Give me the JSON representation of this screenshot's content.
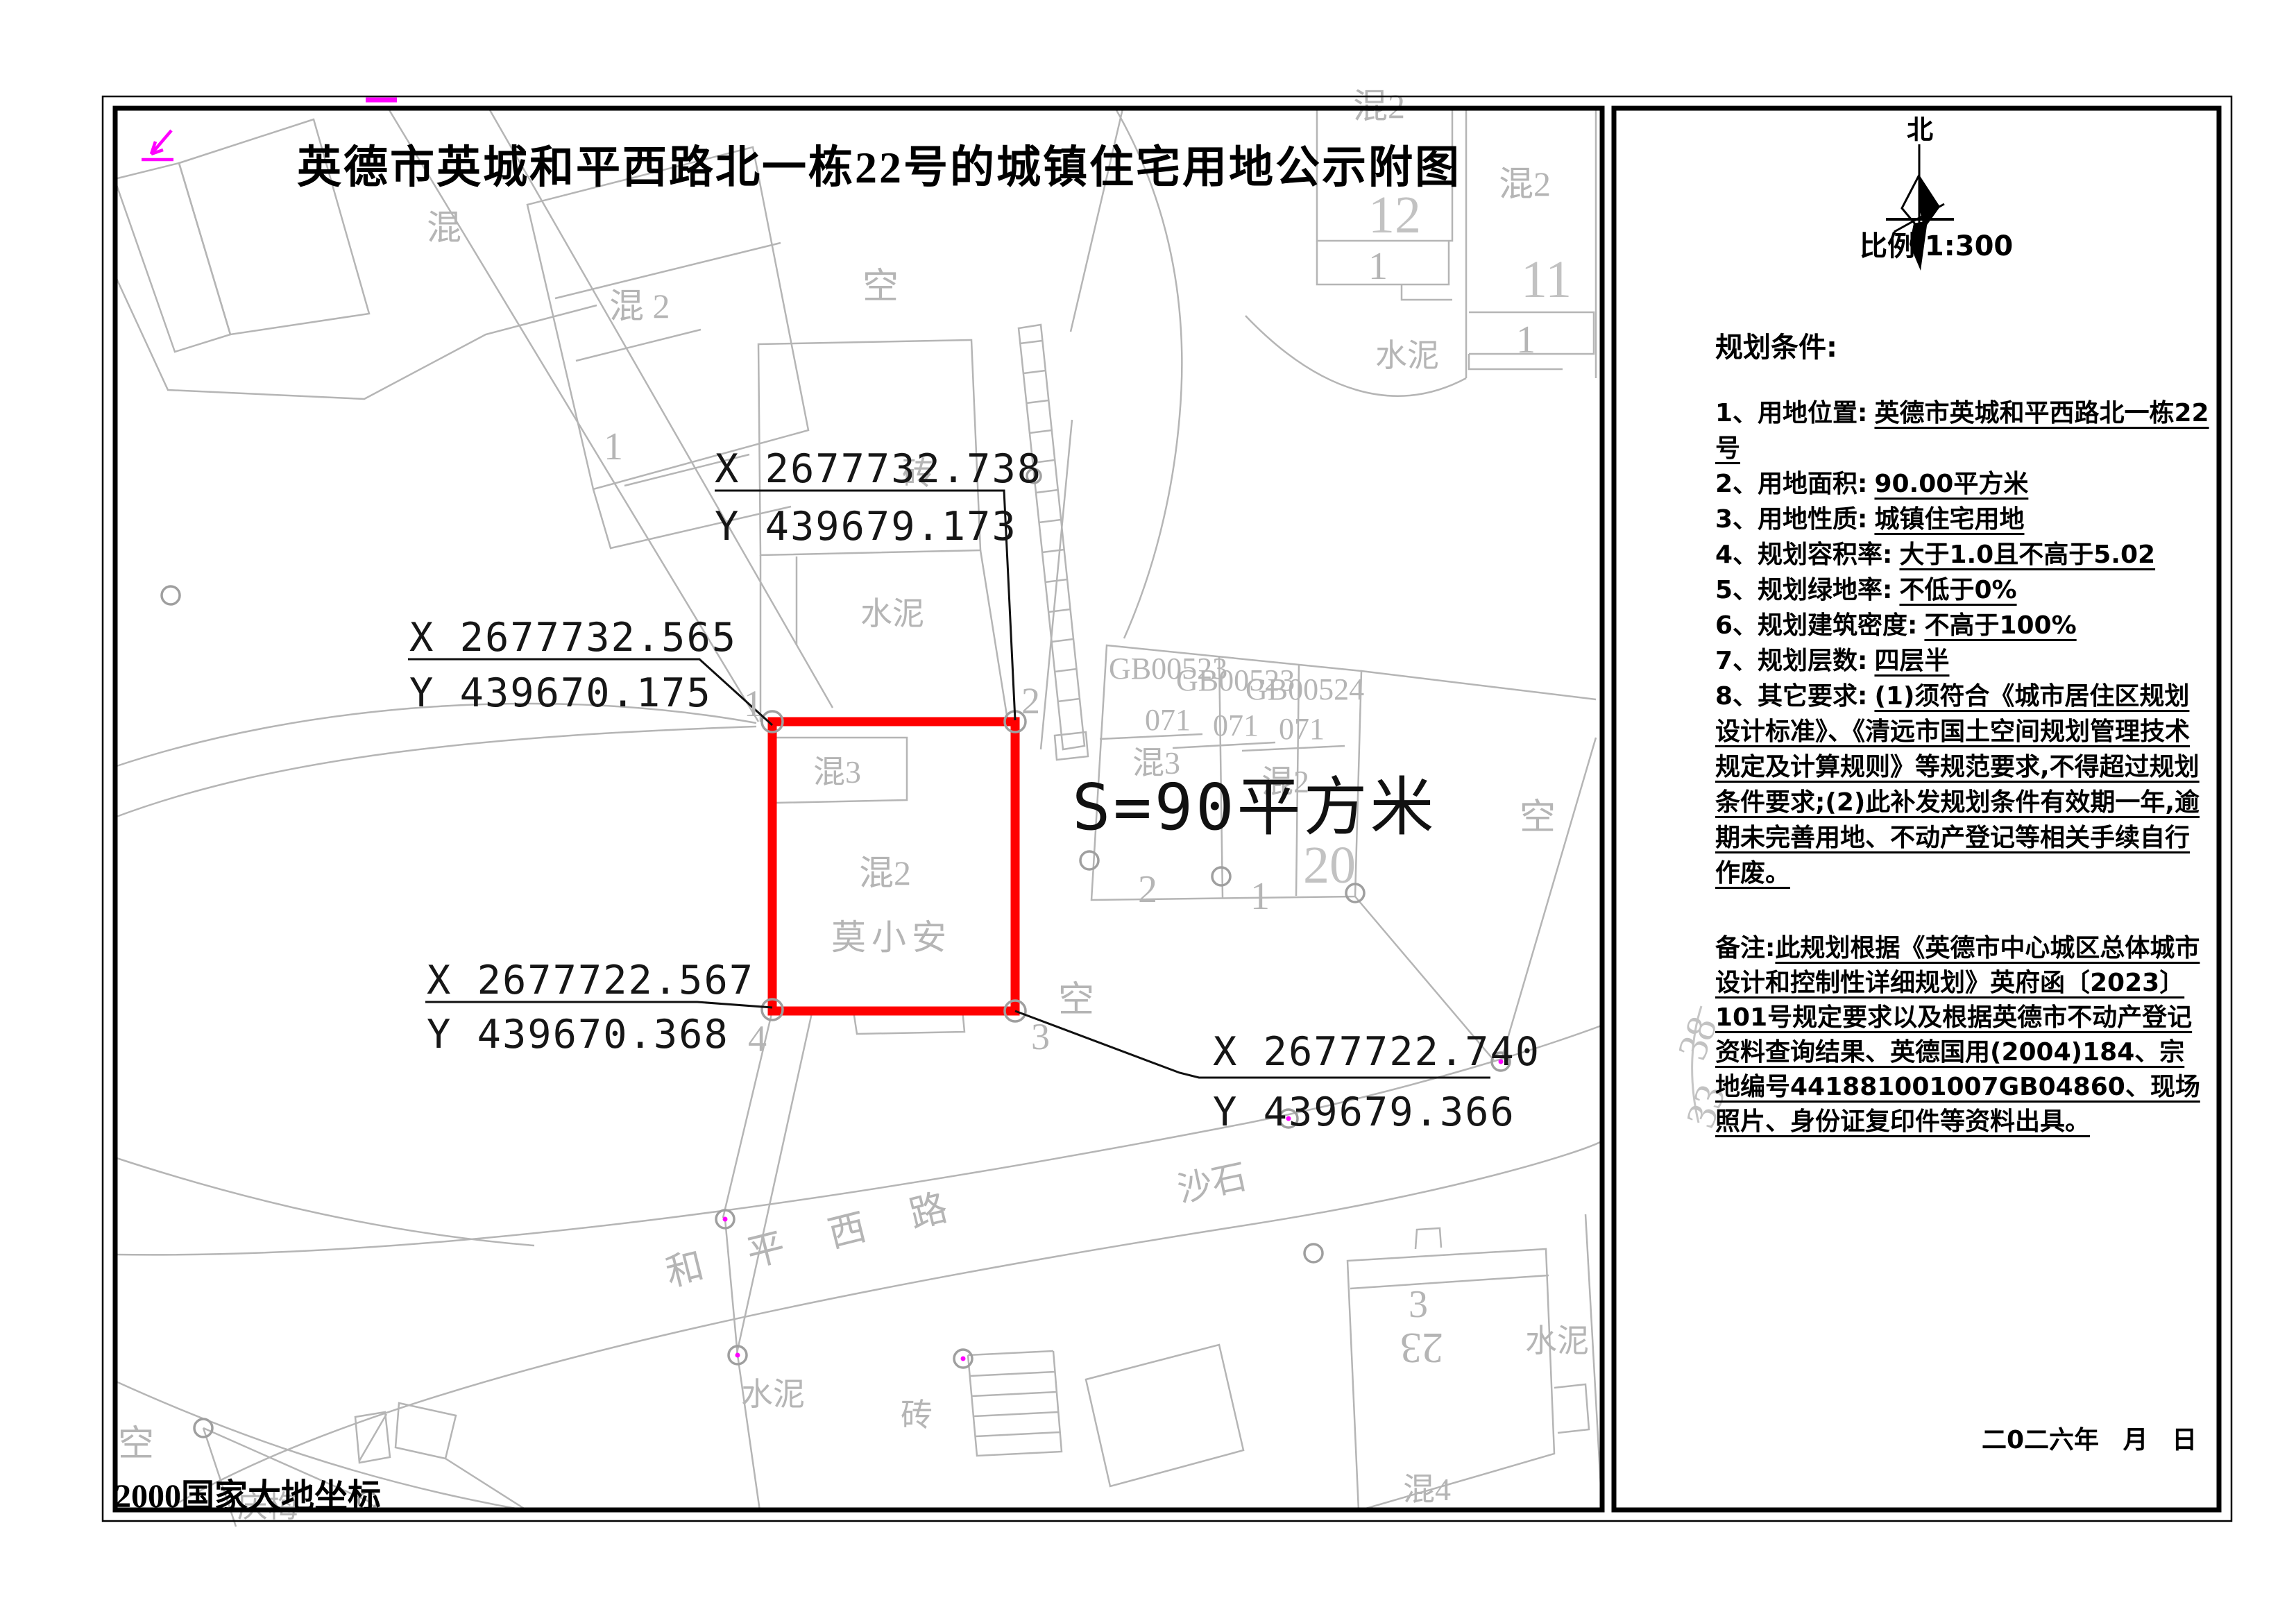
{
  "title": "英德市英城和平西路北一栋22号的城镇住宅用地公示附图",
  "map": {
    "area_label": "S=90平方米",
    "datum_label": "2000国家大地坐标",
    "parcel_owner": "莫小安",
    "coords": [
      {
        "x": "X 2677732.565",
        "y": "Y 439670.175"
      },
      {
        "x": "X 2677732.738",
        "y": "Y 439679.173"
      },
      {
        "x": "X 2677722.740",
        "y": "Y 439679.366"
      },
      {
        "x": "X 2677722.567",
        "y": "Y 439670.368"
      }
    ],
    "labels": [
      "混",
      "混 2",
      "空",
      "混2",
      "12",
      "1",
      "混2",
      "11",
      "1",
      "水泥",
      "砖",
      "水泥",
      "混3",
      "混2",
      "莫小安",
      "GB00523",
      "071",
      "GB00523",
      "071",
      "GB00524",
      "071",
      "混3",
      "混2",
      "20",
      "2",
      "1",
      "空",
      "空",
      "和",
      "平",
      "西",
      "路",
      "沙石",
      "水泥",
      "砖",
      "3",
      "23",
      "水泥",
      "混4",
      "空",
      "庆梅",
      "38",
      "33",
      "1",
      "2",
      "3",
      "4",
      "1"
    ]
  },
  "panel": {
    "north_label": "北",
    "scale_label": "比例  1:300",
    "section_title": "规划条件:",
    "items": [
      {
        "label": "1、用地位置:",
        "value": "英德市英城和平西路北一栋22号"
      },
      {
        "label": "2、用地面积:",
        "value": "90.00平方米"
      },
      {
        "label": "3、用地性质:",
        "value": "城镇住宅用地"
      },
      {
        "label": "4、规划容积率:",
        "value": "大于1.0且不高于5.02"
      },
      {
        "label": "5、规划绿地率:",
        "value": "不低于0%"
      },
      {
        "label": "6、规划建筑密度:",
        "value": "不高于100%"
      },
      {
        "label": "7、规划层数:",
        "value": "四层半"
      },
      {
        "label": "8、其它要求:",
        "value": "(1)须符合《城市居住区规划设计标准》、《清远市国土空间规划管理技术规定及计算规则》等规范要求,不得超过规划条件要求;(2)此补发规划条件有效期一年,逾期未完善用地、不动产登记等相关手续自行作废。"
      }
    ],
    "note_label": "备注:",
    "note_value": "此规划根据《英德市中心城区总体城市设计和控制性详细规划》英府函〔2023〕101号规定要求以及根据英德市不动产登记资料查询结果、英德国用(2004)184、宗地编号441881001007GB04860、现场照片、身份证复印件等资料出具。",
    "date_label": "二0二六年 月 日"
  },
  "colors": {
    "parcel_outline": "#ff0000",
    "survey_mark": "#ff00ff",
    "map_line": "#b5b5b5",
    "ink": "#000000"
  }
}
